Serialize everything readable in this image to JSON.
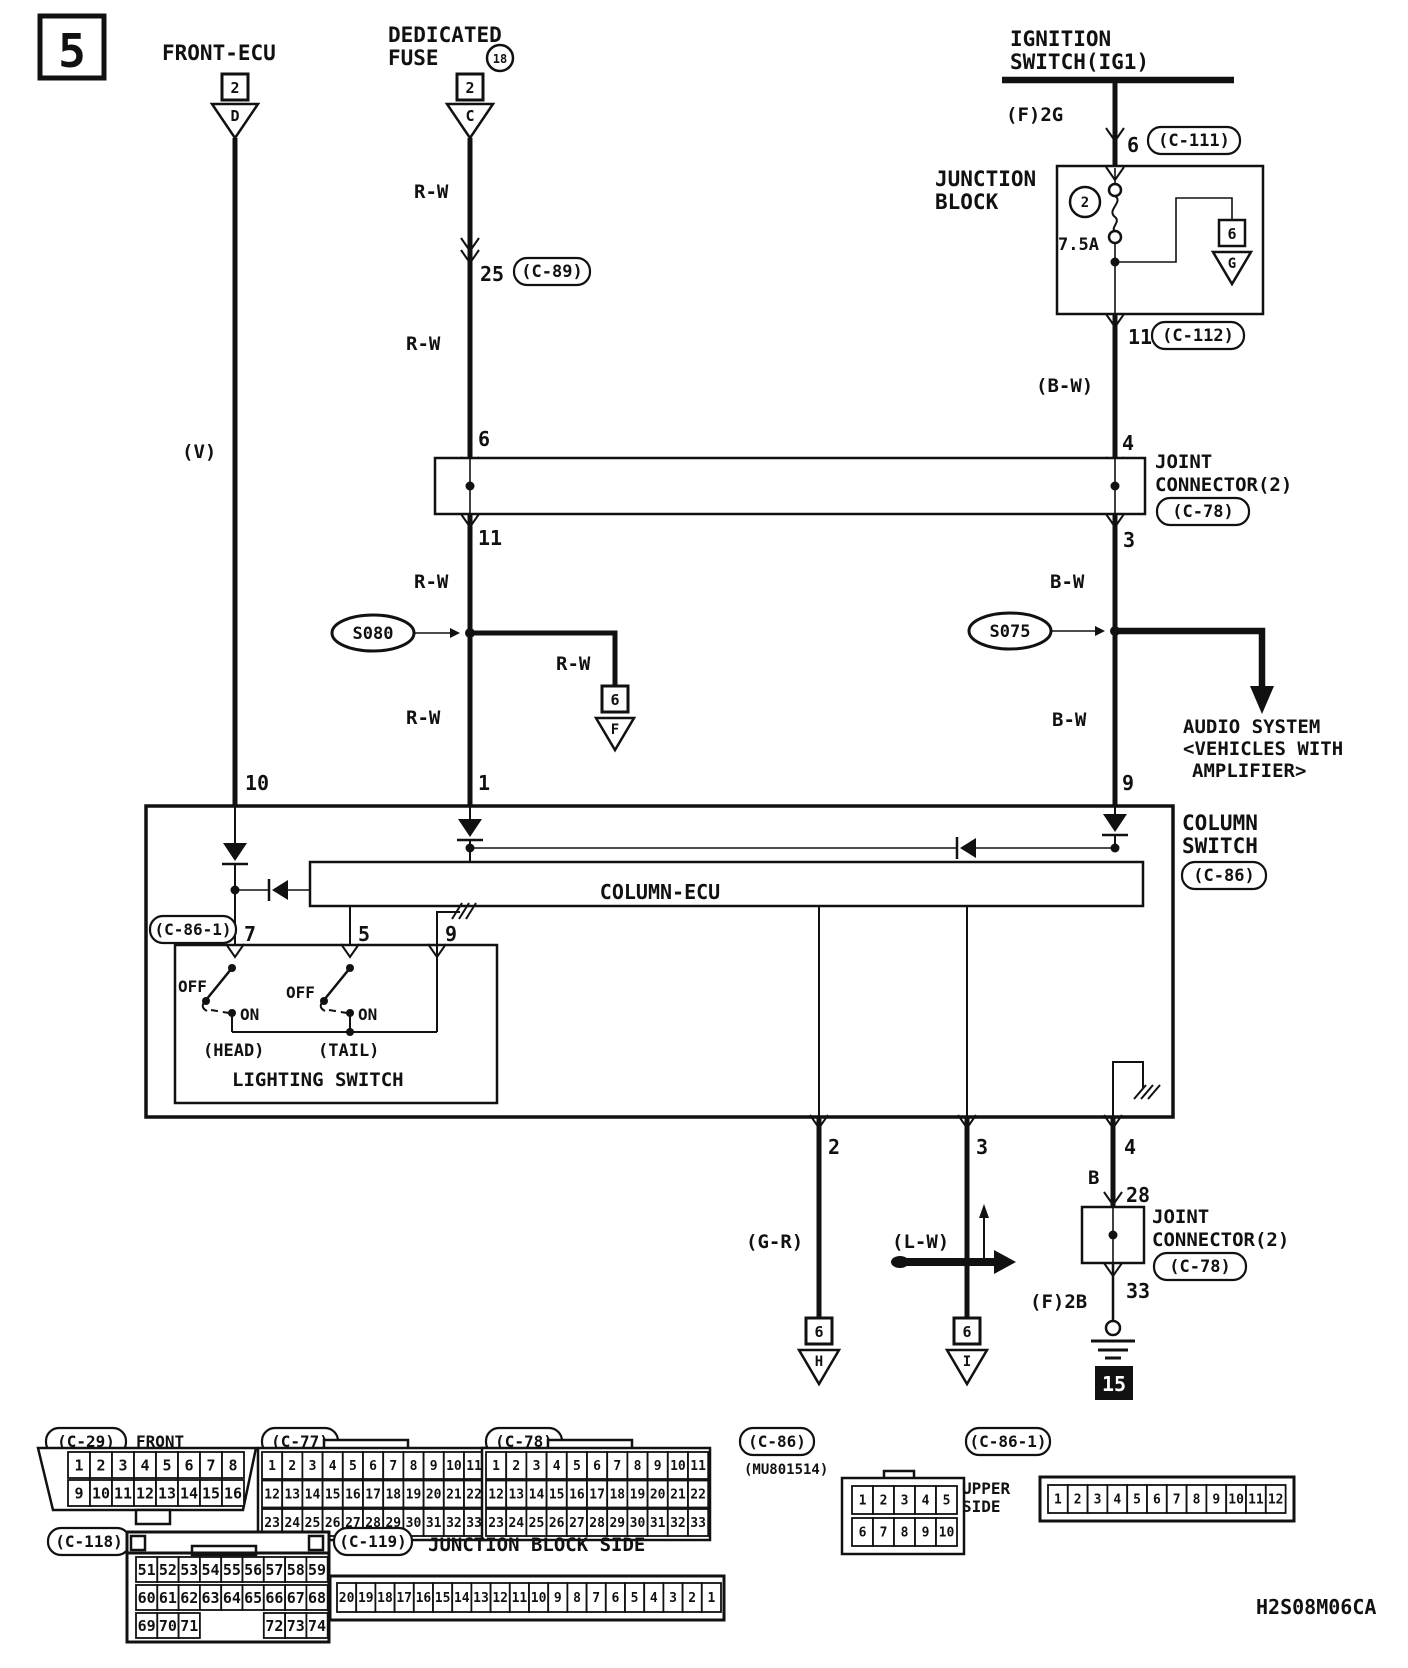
{
  "page": {
    "number": "5",
    "code": "H2S08M06CA"
  },
  "top": {
    "front_ecu": "FRONT-ECU",
    "front_ecu_pins": "2",
    "front_ecu_conn": "D",
    "ded1": "DEDICATED",
    "ded2": "FUSE",
    "fuse_no": "18",
    "ded_pins": "2",
    "ded_conn": "C",
    "ign1": "IGNITION",
    "ign2": "SWITCH(IG1)",
    "f2g": "(F)2G",
    "pin6": "6",
    "c111": "(C-111)"
  },
  "jb": {
    "l1": "JUNCTION",
    "l2": "BLOCK",
    "circ": "2",
    "amp": "7.5A",
    "pin6": "6",
    "conn_g": "G",
    "pin11": "11",
    "c112": "(C-112)"
  },
  "wires": {
    "v": "(V)",
    "rw": "R-W",
    "bw": "B-W",
    "bw_p": "(B-W)",
    "gr": "(G-R)",
    "lw": "(L-W)",
    "b": "B"
  },
  "mid": {
    "pin25": "25",
    "c89": "(C-89)",
    "pin6": "6",
    "pin11": "11",
    "pin4": "4",
    "pin3": "3",
    "jc_l1": "JOINT",
    "jc_l2": "CONNECTOR(2)",
    "c78": "(C-78)",
    "s080": "S080",
    "s075": "S075",
    "pin6f": "6",
    "conn_f": "F",
    "audio1": "AUDIO SYSTEM",
    "audio2": "<VEHICLES WITH",
    "audio3": "AMPLIFIER>",
    "pin1": "1",
    "pin9": "9",
    "pin10": "10"
  },
  "cs": {
    "l1": "COLUMN",
    "l2": "SWITCH",
    "c86": "(C-86)",
    "ecu": "COLUMN-ECU",
    "c861": "(C-86-1)",
    "pin7": "7",
    "pin5": "5",
    "pin9": "9",
    "off": "OFF",
    "on": "ON",
    "head": "(HEAD)",
    "tail": "(TAIL)",
    "lighting": "LIGHTING SWITCH",
    "pin2": "2",
    "pin3": "3",
    "pin4": "4",
    "pin28": "28",
    "pin33": "33",
    "f2b": "(F)2B",
    "g15": "15",
    "pin6": "6",
    "conn_h": "H",
    "conn_i": "I"
  },
  "pinouts": {
    "c29": {
      "label": "(C-29)",
      "note1": "FRONT",
      "note2": "SIDE",
      "rows": [
        [
          "1",
          "2",
          "3",
          "4",
          "5",
          "6",
          "7",
          "8"
        ],
        [
          "9",
          "10",
          "11",
          "12",
          "13",
          "14",
          "15",
          "16"
        ]
      ]
    },
    "c77": {
      "label": "(C-77)",
      "rows": [
        [
          "1",
          "2",
          "3",
          "4",
          "5",
          "6",
          "7",
          "8",
          "9",
          "10",
          "11"
        ],
        [
          "12",
          "13",
          "14",
          "15",
          "16",
          "17",
          "18",
          "19",
          "20",
          "21",
          "22"
        ],
        [
          "23",
          "24",
          "25",
          "26",
          "27",
          "28",
          "29",
          "30",
          "31",
          "32",
          "33"
        ]
      ]
    },
    "c78": {
      "label": "(C-78)",
      "rows": [
        [
          "1",
          "2",
          "3",
          "4",
          "5",
          "6",
          "7",
          "8",
          "9",
          "10",
          "11"
        ],
        [
          "12",
          "13",
          "14",
          "15",
          "16",
          "17",
          "18",
          "19",
          "20",
          "21",
          "22"
        ],
        [
          "23",
          "24",
          "25",
          "26",
          "27",
          "28",
          "29",
          "30",
          "31",
          "32",
          "33"
        ]
      ]
    },
    "c86": {
      "label": "(C-86)",
      "part": "(MU801514)",
      "rows": [
        [
          "1",
          "2",
          "3",
          "4",
          "5"
        ],
        [
          "6",
          "7",
          "8",
          "9",
          "10"
        ]
      ]
    },
    "c861": {
      "label": "(C-86-1)",
      "note1": "UPPER",
      "note2": "SIDE",
      "rows": [
        [
          "1",
          "2",
          "3",
          "4",
          "5",
          "6",
          "7",
          "8",
          "9",
          "10",
          "11",
          "12"
        ]
      ]
    },
    "c118": {
      "label": "(C-118)",
      "rows": [
        [
          "51",
          "52",
          "53",
          "54",
          "55",
          "56",
          "57",
          "58",
          "59"
        ],
        [
          "60",
          "61",
          "62",
          "63",
          "64",
          "65",
          "66",
          "67",
          "68"
        ],
        [
          "69",
          "70",
          "71",
          null,
          null,
          null,
          "72",
          "73",
          "74"
        ]
      ]
    },
    "c119": {
      "label": "(C-119)",
      "note": "JUNCTION BLOCK SIDE",
      "rows": [
        [
          "20",
          "19",
          "18",
          "17",
          "16",
          "15",
          "14",
          "13",
          "12",
          "11",
          "10",
          "9",
          "8",
          "7",
          "6",
          "5",
          "4",
          "3",
          "2",
          "1"
        ]
      ]
    }
  }
}
